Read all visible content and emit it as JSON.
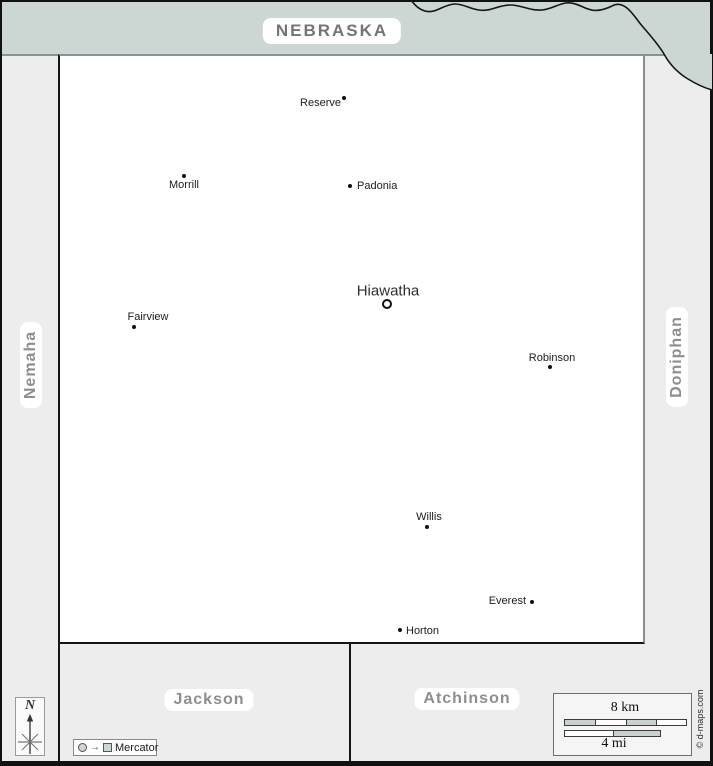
{
  "state_band": {
    "label": "NEBRASKA"
  },
  "neighbors": {
    "west": {
      "label": "Nemaha"
    },
    "east": {
      "label": "Doniphan"
    },
    "south_west": {
      "label": "Jackson"
    },
    "south_east": {
      "label": "Atchinson"
    }
  },
  "cities": [
    {
      "name": "Reserve",
      "dot": [
        344,
        98
      ],
      "label": [
        341,
        103
      ],
      "anchor": "left",
      "seat": false
    },
    {
      "name": "Morrill",
      "dot": [
        184,
        176
      ],
      "label": [
        184,
        185
      ],
      "anchor": "center",
      "seat": false
    },
    {
      "name": "Padonia",
      "dot": [
        350,
        186
      ],
      "label": [
        357,
        186
      ],
      "anchor": "right",
      "seat": false
    },
    {
      "name": "Hiawatha",
      "dot": [
        387,
        304
      ],
      "label": [
        388,
        291
      ],
      "anchor": "center",
      "seat": true
    },
    {
      "name": "Fairview",
      "dot": [
        134,
        327
      ],
      "label": [
        148,
        317
      ],
      "anchor": "center",
      "seat": false
    },
    {
      "name": "Robinson",
      "dot": [
        550,
        367
      ],
      "label": [
        552,
        358
      ],
      "anchor": "center",
      "seat": false
    },
    {
      "name": "Willis",
      "dot": [
        427,
        527
      ],
      "label": [
        429,
        517
      ],
      "anchor": "center",
      "seat": false
    },
    {
      "name": "Everest",
      "dot": [
        532,
        602
      ],
      "label": [
        526,
        601
      ],
      "anchor": "left",
      "seat": false
    },
    {
      "name": "Horton",
      "dot": [
        400,
        630
      ],
      "label": [
        406,
        631
      ],
      "anchor": "right",
      "seat": false
    }
  ],
  "scale": {
    "km_label": "8 km",
    "mi_label": "4 mi"
  },
  "legend": {
    "north": "N",
    "projection": "Mercator"
  },
  "credit": "© d-maps.com",
  "colors": {
    "state_fill": "#ccd6d2",
    "neighbor_fill": "#ededed",
    "county_fill": "#ffffff",
    "region_label": "#8e8e8e",
    "border": "#111111"
  }
}
